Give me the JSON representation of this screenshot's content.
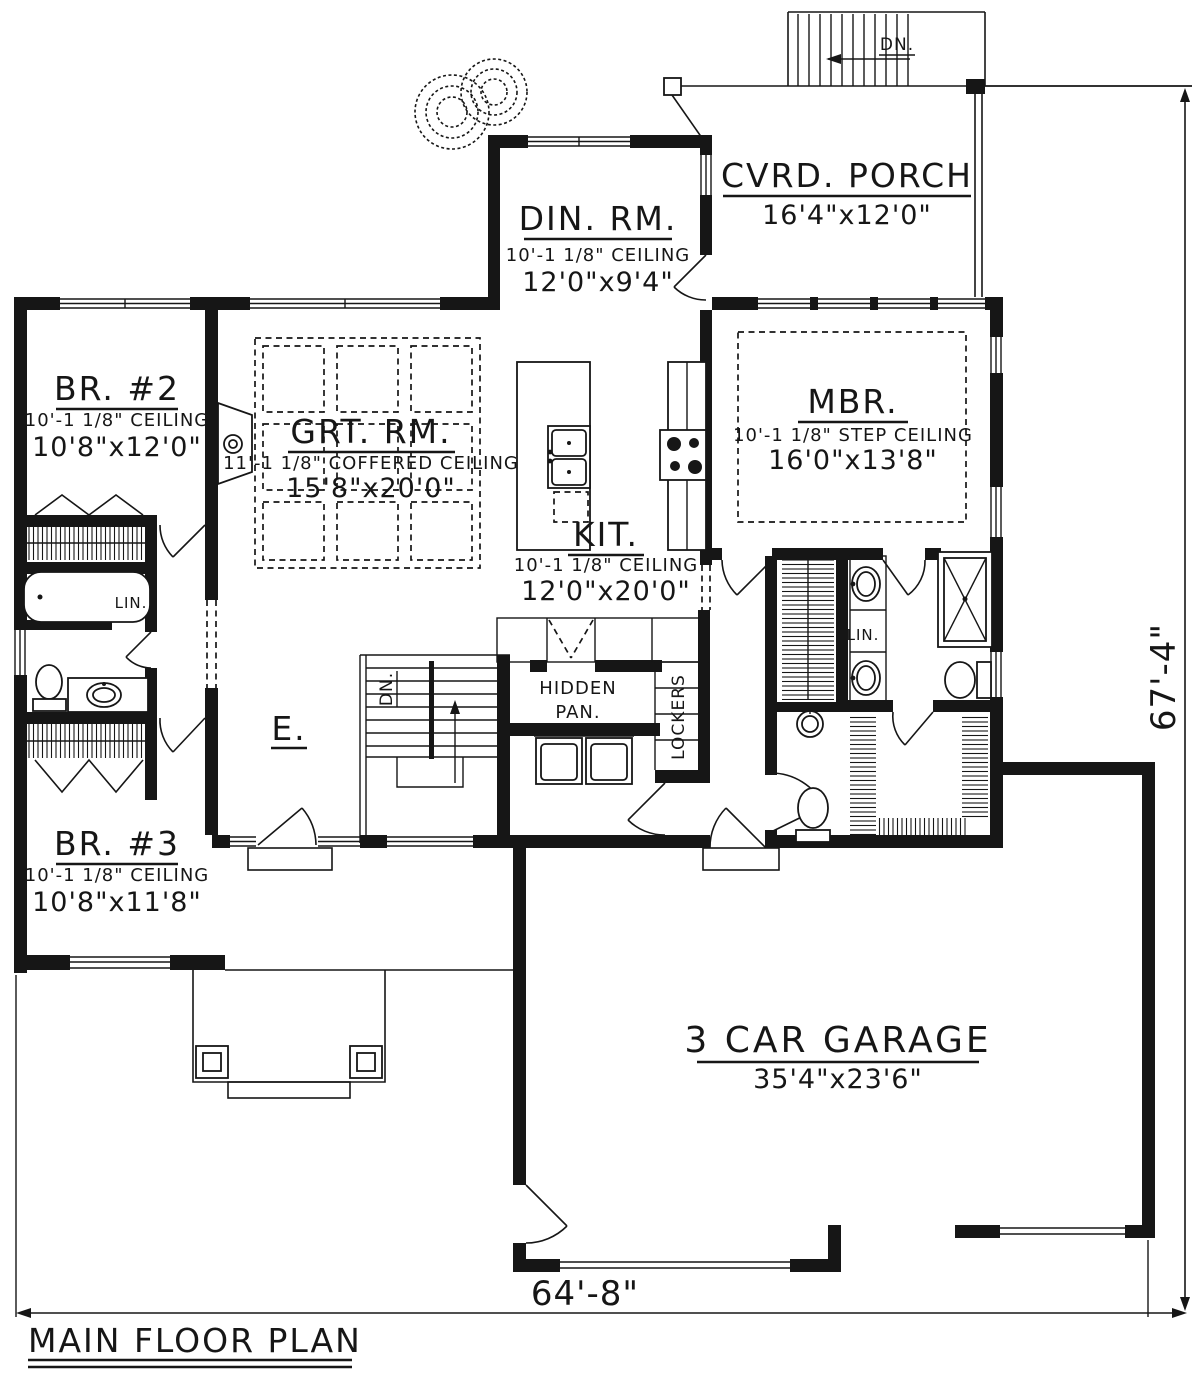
{
  "title": "MAIN FLOOR PLAN",
  "dims": {
    "width": "64'-8\"",
    "height": "67'-4\""
  },
  "rooms": {
    "porch": {
      "label": "CVRD. PORCH",
      "size": "16'4\"x12'0\""
    },
    "dining": {
      "label": "DIN. RM.",
      "ceiling": "10'-1 1/8\" CEILING",
      "size": "12'0\"x9'4\""
    },
    "br2": {
      "label": "BR. #2",
      "ceiling": "10'-1 1/8\" CEILING",
      "size": "10'8\"x12'0\""
    },
    "great": {
      "label": "GRT. RM.",
      "ceiling": "11'-1 1/8\" COFFERED CEILING",
      "size": "15'8\"x20'0\""
    },
    "mbr": {
      "label": "MBR.",
      "ceiling": "10'-1 1/8\" STEP CEILING",
      "size": "16'0\"x13'8\""
    },
    "kitchen": {
      "label": "KIT.",
      "ceiling": "10'-1 1/8\" CEILING",
      "size": "12'0\"x20'0\""
    },
    "br3": {
      "label": "BR. #3",
      "ceiling": "10'-1 1/8\" CEILING",
      "size": "10'8\"x11'8\""
    },
    "garage": {
      "label": "3 CAR GARAGE",
      "size": "35'4\"x23'6\""
    },
    "pantry": {
      "line1": "HIDDEN",
      "line2": "PAN."
    },
    "lockers": {
      "label": "LOCKERS"
    },
    "entry": {
      "label": "E."
    },
    "linen_hall": {
      "label": "LIN."
    },
    "linen_master": {
      "label": "LIN."
    }
  },
  "stairs": {
    "deck_dn": "DN.",
    "main_dn": "DN."
  },
  "colors": {
    "ink": "#161616",
    "paper": "#ffffff"
  }
}
